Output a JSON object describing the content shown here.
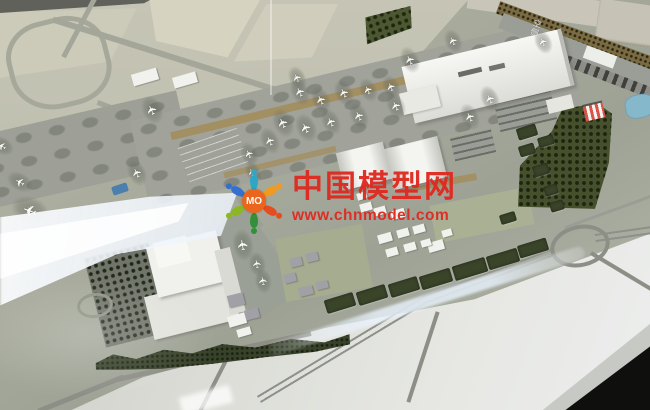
{
  "watermark": {
    "brand": "中国模型网",
    "url": "www.chnmodel.com",
    "logo_text": "MO",
    "text_color": "#df2a21"
  },
  "ground_label": {
    "text": "空侧"
  },
  "palette": {
    "watermark_red": "#df2a21",
    "logo_center_orange": "#ef6318",
    "logo_petal_colors": [
      "#2aa7c8",
      "#f59a1b",
      "#e8491c",
      "#2f8f35",
      "#8ab821",
      "#2f6fd2"
    ],
    "forest_green": "#46502c",
    "water_blue": "#86b8cc",
    "apron_gray": "#a1a39b",
    "field_beige": "#d6d3c1"
  },
  "scene": {
    "plane_glyph": "✈",
    "planes": [
      {
        "x": 152,
        "y": 110,
        "s": 13
      },
      {
        "x": 297,
        "y": 78,
        "s": 11
      },
      {
        "x": 300,
        "y": 92,
        "s": 12
      },
      {
        "x": 321,
        "y": 100,
        "s": 12
      },
      {
        "x": 344,
        "y": 93,
        "s": 12
      },
      {
        "x": 368,
        "y": 90,
        "s": 11
      },
      {
        "x": 391,
        "y": 87,
        "s": 11
      },
      {
        "x": 283,
        "y": 123,
        "s": 13
      },
      {
        "x": 306,
        "y": 128,
        "s": 13
      },
      {
        "x": 331,
        "y": 122,
        "s": 12
      },
      {
        "x": 359,
        "y": 116,
        "s": 12
      },
      {
        "x": 396,
        "y": 106,
        "s": 12
      },
      {
        "x": 270,
        "y": 141,
        "s": 12
      },
      {
        "x": 249,
        "y": 154,
        "s": 11
      },
      {
        "x": 253,
        "y": 172,
        "s": 10
      },
      {
        "x": 410,
        "y": 60,
        "s": 12
      },
      {
        "x": 453,
        "y": 41,
        "s": 11
      },
      {
        "x": 543,
        "y": 42,
        "s": 11
      },
      {
        "x": 470,
        "y": 117,
        "s": 12
      },
      {
        "x": 490,
        "y": 99,
        "s": 12
      },
      {
        "x": 137,
        "y": 173,
        "s": 12
      },
      {
        "x": 30,
        "y": 210,
        "s": 17,
        "r": -160
      },
      {
        "x": 20,
        "y": 182,
        "s": 12,
        "r": -150
      },
      {
        "x": 2,
        "y": 146,
        "s": 11,
        "r": -150
      },
      {
        "x": 243,
        "y": 245,
        "s": 14,
        "r": -100
      },
      {
        "x": 257,
        "y": 264,
        "s": 11,
        "r": -100
      },
      {
        "x": 263,
        "y": 281,
        "s": 11,
        "r": -100
      }
    ],
    "hedges": [
      {
        "x": 340,
        "y": 303,
        "w": 30,
        "h": 14
      },
      {
        "x": 372,
        "y": 295,
        "w": 30,
        "h": 14
      },
      {
        "x": 404,
        "y": 287,
        "w": 30,
        "h": 14
      },
      {
        "x": 436,
        "y": 279,
        "w": 32,
        "h": 14
      },
      {
        "x": 470,
        "y": 269,
        "w": 34,
        "h": 15
      },
      {
        "x": 503,
        "y": 259,
        "w": 32,
        "h": 14
      },
      {
        "x": 533,
        "y": 248,
        "w": 30,
        "h": 13
      },
      {
        "x": 527,
        "y": 150,
        "w": 16,
        "h": 11
      },
      {
        "x": 541,
        "y": 170,
        "w": 16,
        "h": 11
      },
      {
        "x": 551,
        "y": 190,
        "w": 14,
        "h": 10
      },
      {
        "x": 557,
        "y": 206,
        "w": 14,
        "h": 10
      },
      {
        "x": 508,
        "y": 218,
        "w": 16,
        "h": 10
      },
      {
        "x": 527,
        "y": 132,
        "w": 20,
        "h": 12
      },
      {
        "x": 546,
        "y": 141,
        "w": 16,
        "h": 10
      }
    ],
    "white_buildings": [
      {
        "x": 385,
        "y": 238,
        "w": 14,
        "h": 9
      },
      {
        "x": 403,
        "y": 233,
        "w": 12,
        "h": 8
      },
      {
        "x": 419,
        "y": 229,
        "w": 12,
        "h": 8
      },
      {
        "x": 436,
        "y": 246,
        "w": 16,
        "h": 10
      },
      {
        "x": 392,
        "y": 252,
        "w": 12,
        "h": 8
      },
      {
        "x": 410,
        "y": 247,
        "w": 12,
        "h": 8
      },
      {
        "x": 426,
        "y": 243,
        "w": 10,
        "h": 7
      },
      {
        "x": 447,
        "y": 233,
        "w": 10,
        "h": 7
      },
      {
        "x": 237,
        "y": 320,
        "w": 18,
        "h": 11
      },
      {
        "x": 244,
        "y": 332,
        "w": 14,
        "h": 8
      },
      {
        "x": 366,
        "y": 207,
        "w": 12,
        "h": 8
      },
      {
        "x": 380,
        "y": 211,
        "w": 12,
        "h": 8
      },
      {
        "x": 398,
        "y": 214,
        "w": 14,
        "h": 9
      },
      {
        "x": 362,
        "y": 196,
        "w": 10,
        "h": 7
      },
      {
        "x": 145,
        "y": 77,
        "w": 26,
        "h": 12
      },
      {
        "x": 185,
        "y": 80,
        "w": 24,
        "h": 11
      }
    ],
    "gray_buildings": [
      {
        "x": 236,
        "y": 300,
        "w": 16,
        "h": 12
      },
      {
        "x": 252,
        "y": 314,
        "w": 14,
        "h": 10
      },
      {
        "x": 296,
        "y": 262,
        "w": 12,
        "h": 9
      },
      {
        "x": 312,
        "y": 257,
        "w": 12,
        "h": 9
      },
      {
        "x": 290,
        "y": 278,
        "w": 12,
        "h": 9
      },
      {
        "x": 306,
        "y": 291,
        "w": 14,
        "h": 9
      },
      {
        "x": 322,
        "y": 285,
        "w": 12,
        "h": 8
      }
    ]
  }
}
